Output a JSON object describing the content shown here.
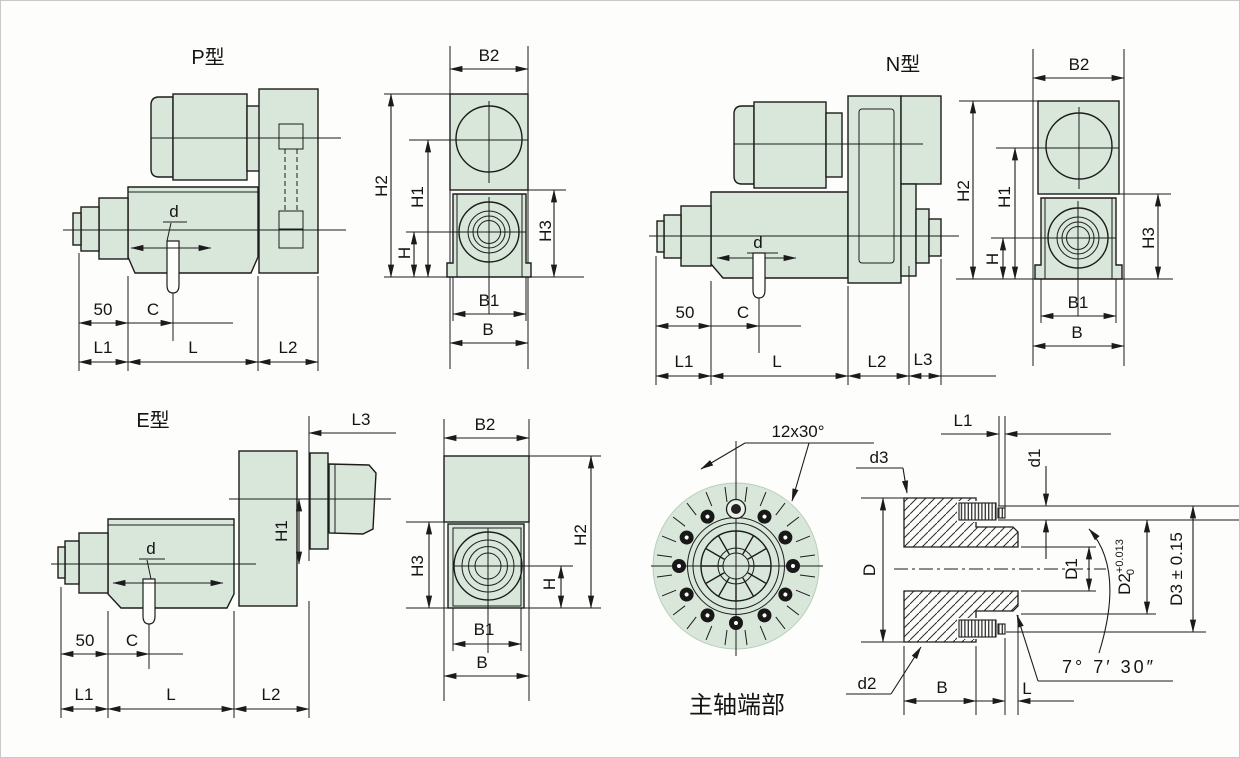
{
  "views": {
    "p_side": {
      "title": "P型",
      "d": "d",
      "n50": "50",
      "c": "C",
      "l1": "L1",
      "l": "L",
      "l2": "L2"
    },
    "p_front": {
      "b2": "B2",
      "h2": "H2",
      "h1": "H1",
      "h": "H",
      "h3": "H3",
      "b1": "B1",
      "b": "B"
    },
    "n_side": {
      "title": "N型",
      "d": "d",
      "n50": "50",
      "c": "C",
      "l1": "L1",
      "l": "L",
      "l2": "L2",
      "l3": "L3"
    },
    "n_front": {
      "b2": "B2",
      "h2": "H2",
      "h1": "H1",
      "h": "H",
      "h3": "H3",
      "b1": "B1",
      "b": "B"
    },
    "e_side": {
      "title": "E型",
      "l3": "L3",
      "h1": "H1",
      "d": "d",
      "n50": "50",
      "c": "C",
      "l1": "L1",
      "l": "L",
      "l2": "L2"
    },
    "e_front": {
      "b2": "B2",
      "h3": "H3",
      "h2": "H2",
      "h": "H",
      "b1": "B1",
      "b": "B"
    },
    "spindle_end": {
      "caption": "主轴端部",
      "note": "12x30°"
    },
    "section": {
      "l1": "L1",
      "d1": "d1",
      "d3": "d3",
      "d2": "d2",
      "D": "D",
      "D1": "D1",
      "D2": "D2",
      "D2_sup": "+0.013",
      "D2_sub": "0",
      "D3": "D3 ± 0.15",
      "b": "B",
      "l": "L",
      "angle": "7° 7′ 30″"
    }
  },
  "colors": {
    "body_fill": "#d9e7da",
    "line": "#1c1c1c",
    "paper": "#fdfdfc"
  }
}
